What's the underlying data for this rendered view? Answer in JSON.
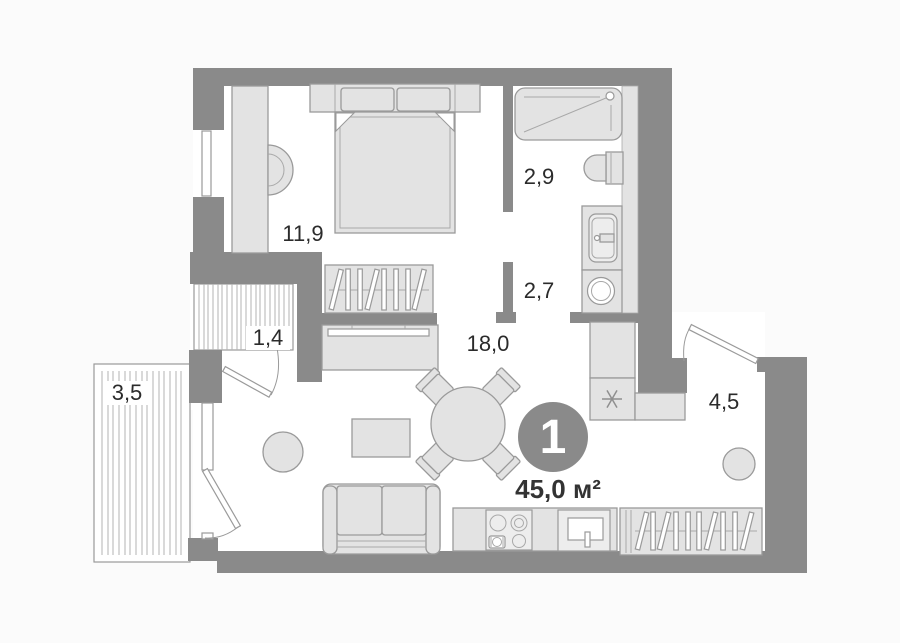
{
  "plan": {
    "badge": {
      "number": "1",
      "total_area_label": "45,0 м²"
    },
    "rooms": [
      {
        "id": "bedroom",
        "area_label": "11,9"
      },
      {
        "id": "bathroom",
        "area_label": "2,9"
      },
      {
        "id": "corridor",
        "area_label": "2,7"
      },
      {
        "id": "living-kitchen",
        "area_label": "18,0"
      },
      {
        "id": "inner-hall",
        "area_label": "1,4"
      },
      {
        "id": "balcony",
        "area_label": "3,5"
      },
      {
        "id": "entry-hall",
        "area_label": "4,5"
      }
    ],
    "colors": {
      "wall": "#8a8a8a",
      "floor": "#ffffff",
      "background": "#fbfbfb",
      "furniture_fill": "#e3e3e3",
      "furniture_stroke": "#9a9a9a",
      "hatch_line": "#b3b3b3",
      "badge_fill": "#8a8a8a",
      "badge_text": "#ffffff",
      "label_text": "#2b2b2b"
    }
  }
}
